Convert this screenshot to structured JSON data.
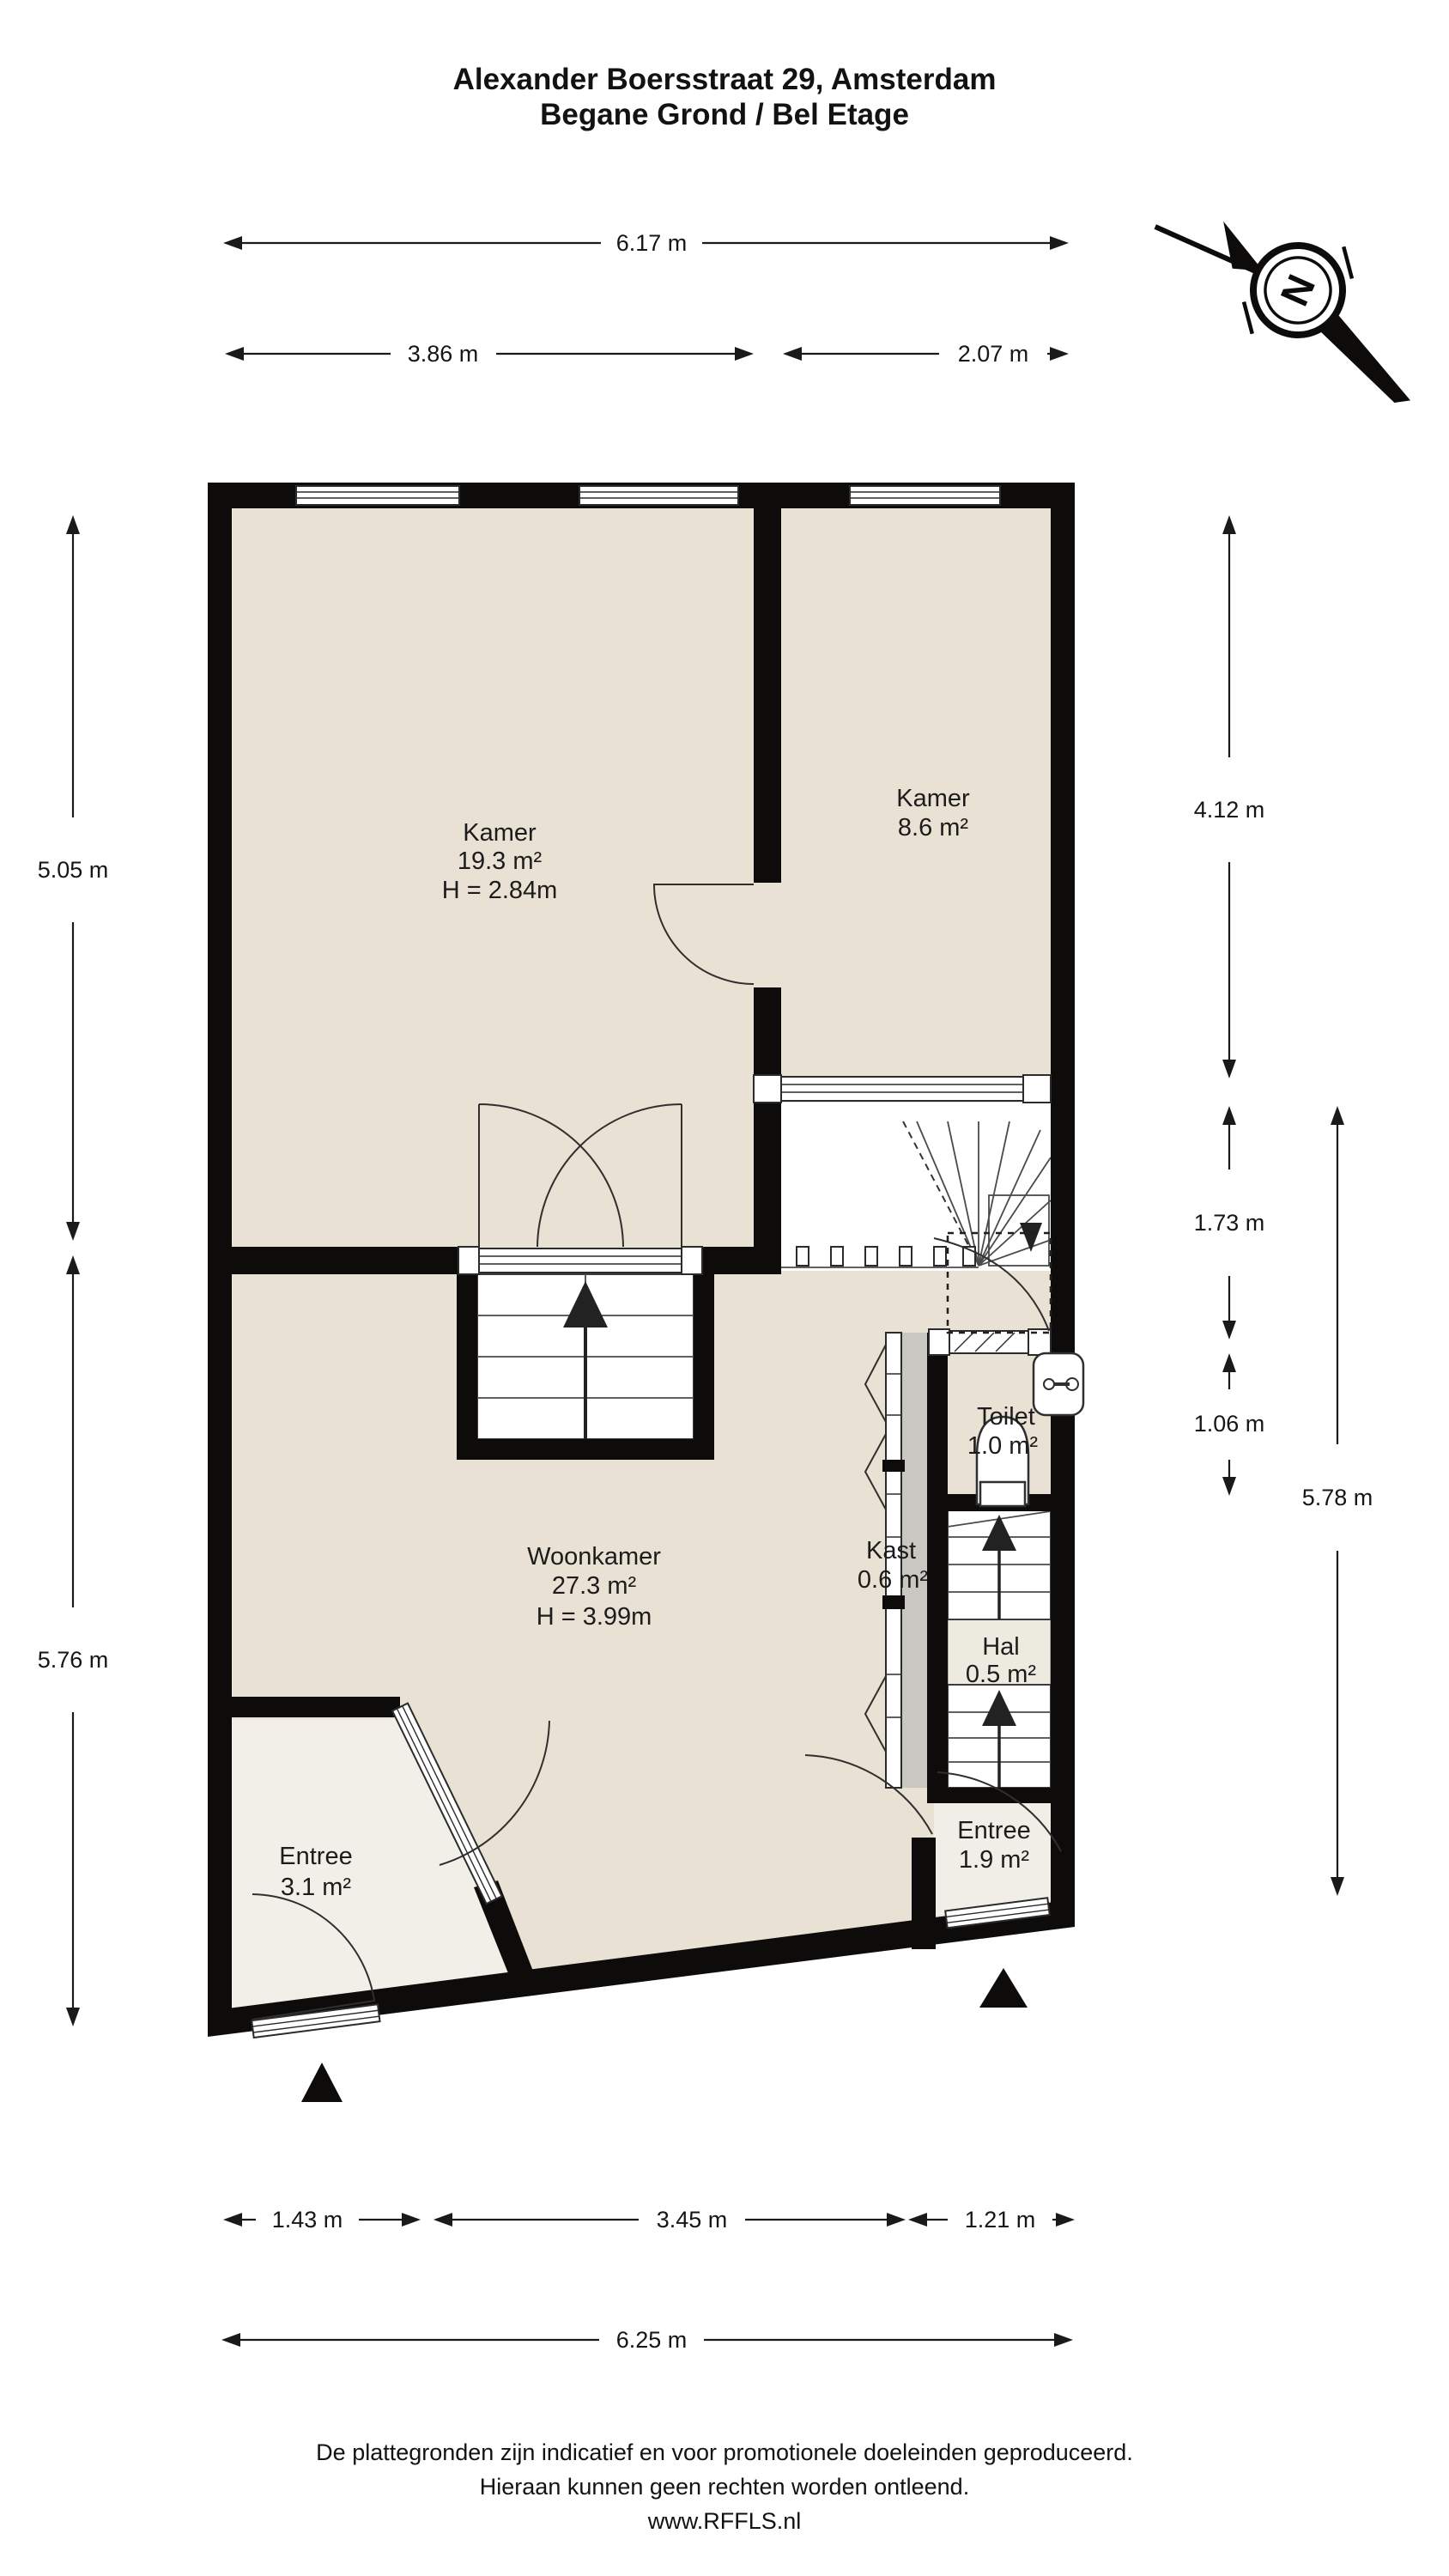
{
  "title": {
    "line1": "Alexander Boersstraat 29, Amsterdam",
    "line2": "Begane Grond / Bel Etage"
  },
  "compass": {
    "north_label": "N"
  },
  "rooms": {
    "kamer1": {
      "name": "Kamer",
      "area": "19.3 m²",
      "height": "H = 2.84m"
    },
    "kamer2": {
      "name": "Kamer",
      "area": "8.6 m²"
    },
    "woonkamer": {
      "name": "Woonkamer",
      "area": "27.3 m²",
      "height": "H = 3.99m"
    },
    "toilet": {
      "name": "Toilet",
      "area": "1.0 m²"
    },
    "kast": {
      "name": "Kast",
      "area": "0.6 m²"
    },
    "hal": {
      "name": "Hal",
      "area": "0.5 m²"
    },
    "entree1": {
      "name": "Entree",
      "area": "3.1 m²"
    },
    "entree2": {
      "name": "Entree",
      "area": "1.9 m²"
    }
  },
  "dimensions": {
    "top_total": "6.17 m",
    "top_left": "3.86 m",
    "top_right": "2.07 m",
    "left_upper": "5.05 m",
    "left_lower": "5.76 m",
    "right_upper": "4.12 m",
    "right_mid": "1.73 m",
    "right_small": "1.06 m",
    "right_total": "5.78 m",
    "bottom_left": "1.43 m",
    "bottom_mid": "3.45 m",
    "bottom_right": "1.21 m",
    "bottom_total": "6.25 m"
  },
  "footer": {
    "line1": "De plattegronden zijn indicatief en voor promotionele doeleinden geproduceerd.",
    "line2": "Hieraan kunnen geen rechten worden ontleend.",
    "line3": "www.RFFLS.nl"
  },
  "colors": {
    "floor": "#e9e1d3",
    "floor_light": "#f1efe8",
    "hal_floor": "#edeadf",
    "kast_gray": "#c9c7c2",
    "wall": "#0e0c0b",
    "line": "#1a1a1a"
  }
}
